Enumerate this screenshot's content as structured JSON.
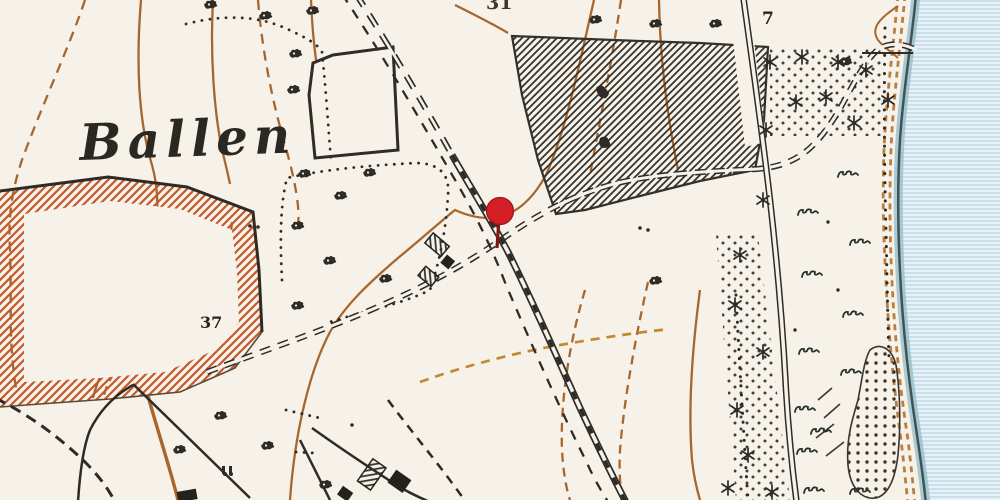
{
  "map": {
    "title": "Historical topographic map sheet — Ballen (coastal detail)",
    "place_label": "Ballen",
    "spot_height": "37",
    "parcel_number_top": "31",
    "parcel_number_right": "7",
    "marker": {
      "type": "location-pin",
      "color": "#d41f27"
    },
    "features": {
      "water": "sea with horizontal ruling along east edge",
      "forest": "diagonal-hatched plantation, north-east",
      "field": "orange-hatched enclosure, west",
      "railway": "double line with sleeper dashes running NW-SE",
      "roads": "double dashed tracks crossing at the pin",
      "vegetation": "scrub clumps, conifer stars, grass tufts, sand stipple"
    },
    "colors": {
      "paper": "#f6f2ea",
      "ink": "#2e2b26",
      "contour_brown": "#a8662c",
      "path_gold": "#c08a2e",
      "field_hatch_orange": "#c2592a",
      "water_base": "#e7f2f7",
      "water_line": "#adccdb",
      "coast_band": "#8fbccb",
      "pin_red": "#d41f27"
    }
  }
}
